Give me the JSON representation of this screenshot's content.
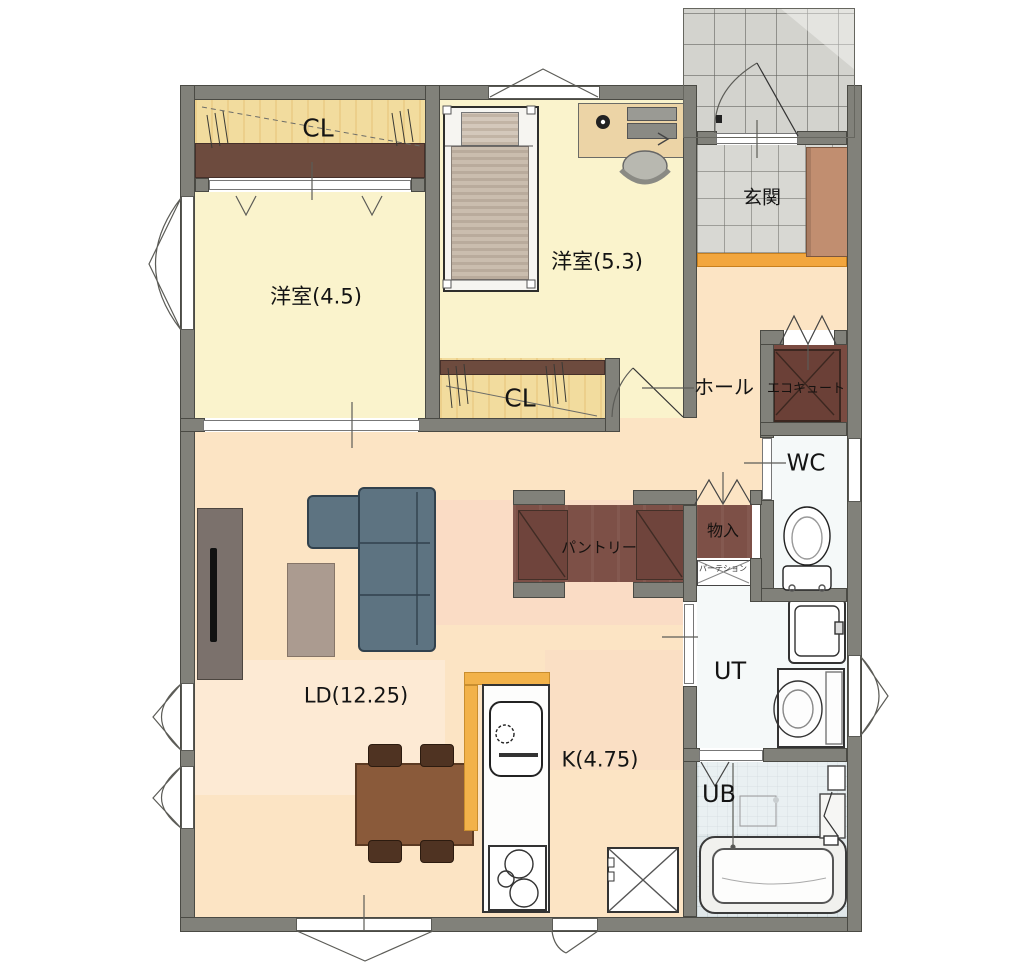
{
  "floor_plan": {
    "rooms": {
      "closet1": {
        "label": "CL"
      },
      "bedroom_45": {
        "label": "洋室(4.5)"
      },
      "bedroom_53": {
        "label": "洋室(5.3)"
      },
      "closet2": {
        "label": "CL"
      },
      "entrance": {
        "label": "玄関"
      },
      "hall": {
        "label": "ホール"
      },
      "ecocute": {
        "label": "エコキュート"
      },
      "toilet_room": {
        "label": "WC"
      },
      "storage": {
        "label": "物入"
      },
      "pantry": {
        "label": "パントリー"
      },
      "partition": {
        "label": "パーテション"
      },
      "living_dining": {
        "label": "LD(12.25)"
      },
      "kitchen": {
        "label": "K(4.75)"
      },
      "utility": {
        "label": "UT"
      },
      "bath": {
        "label": "UB"
      }
    },
    "colors": {
      "wall": "#81817a",
      "bedroom_floor": "#faf3cc",
      "closet_wood_floor": "#f2dc9e",
      "closet_shelf": "#6d4b3e",
      "ld_floor": "#fce4c4",
      "dark_storage_floor": "#7d5047",
      "entrance_tile": "#d8d8d3",
      "entrance_step": "#f2a63e",
      "kitchen_counter_top": "#f2b24a",
      "sofa": "#5d7381",
      "dining_table": "#8a5a3a",
      "bath_floor": "#e1e8ea"
    }
  }
}
